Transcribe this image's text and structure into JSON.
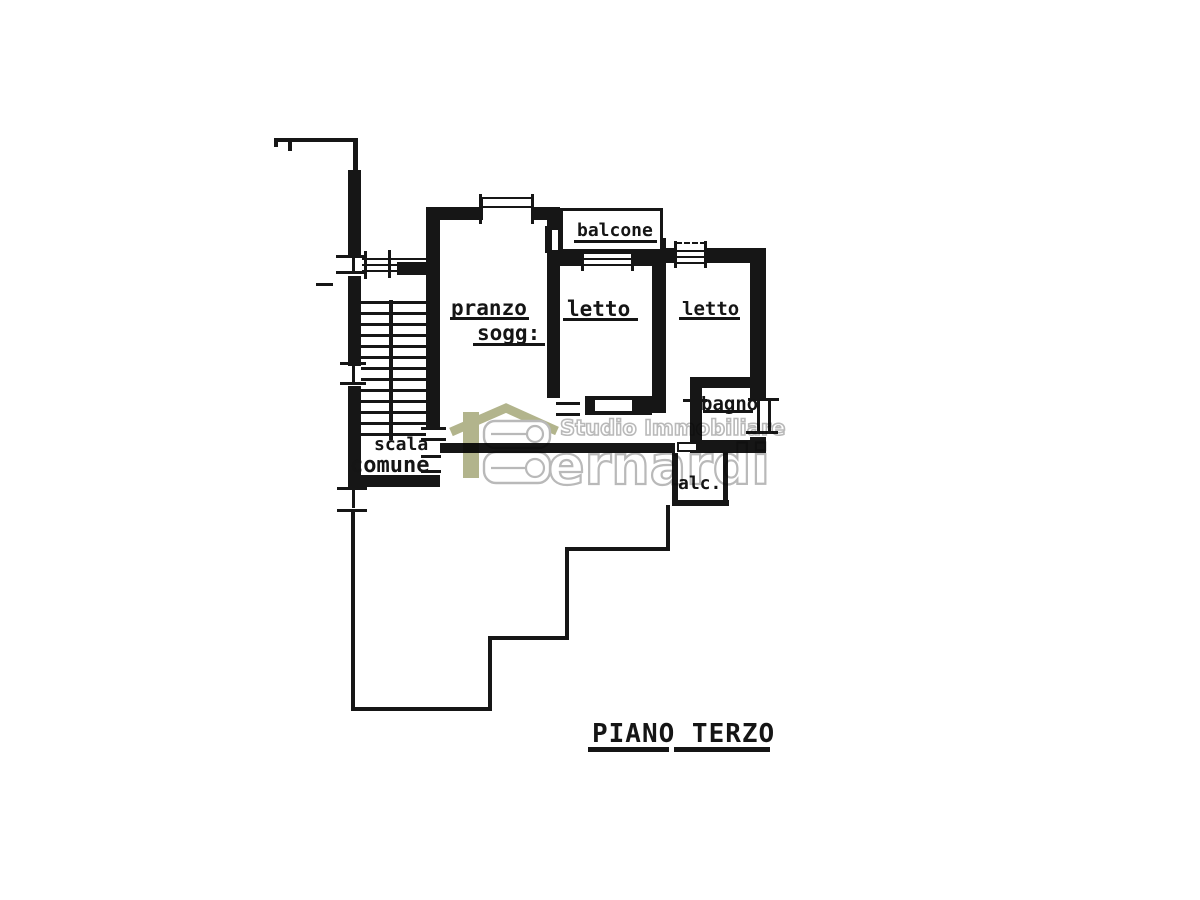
{
  "floor_title": "PIANO TERZO",
  "rooms": {
    "dining_line1": "pranzo",
    "dining_line2": "sogg:",
    "balcony": "balcone",
    "bedroom_left": "letto",
    "bedroom_right": "letto",
    "bathroom": "bagno",
    "alcove": "alc.",
    "stairs_line1": "scala",
    "stairs_line2": "comune"
  },
  "watermark": {
    "monogram": "iB",
    "agency_line1": "Studio Immobiliare",
    "agency_line2": "ernardi",
    "olive_color": "#b2b48c",
    "gray_color": "#b9b9b9"
  },
  "colors": {
    "ink": "#161616",
    "paper": "#ffffff"
  }
}
